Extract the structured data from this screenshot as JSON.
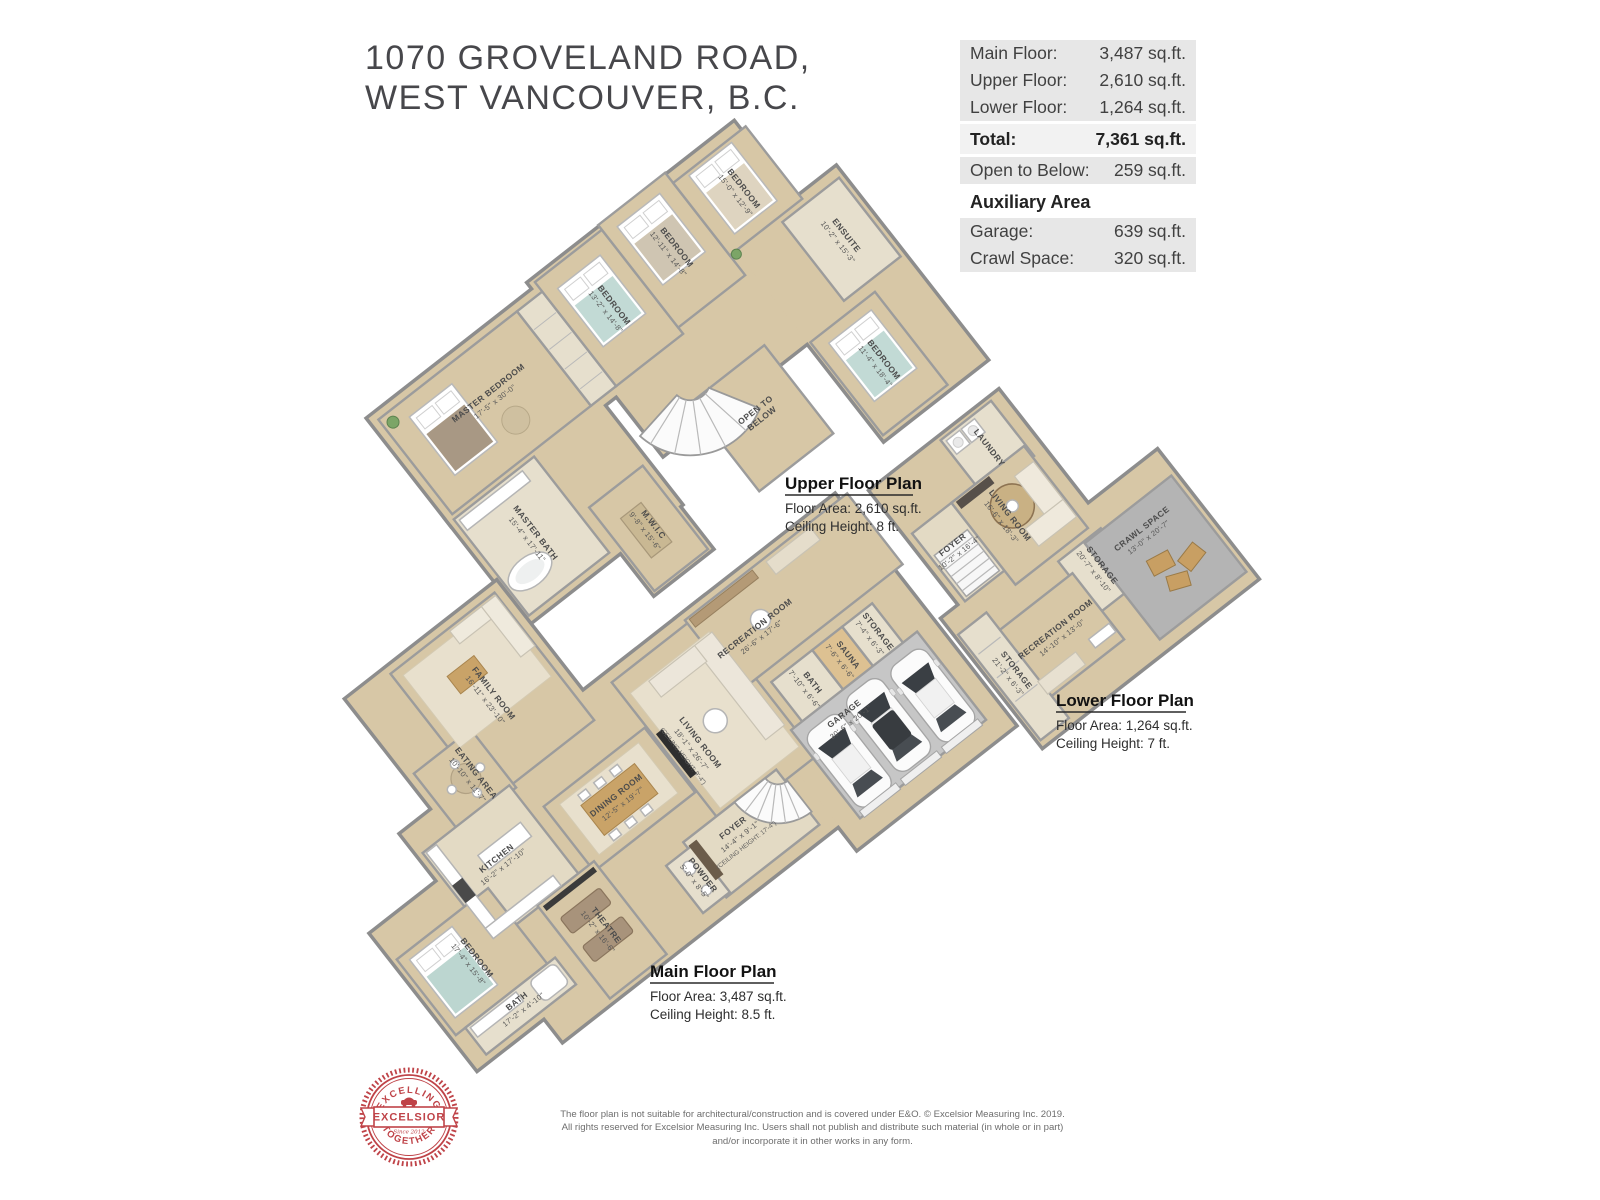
{
  "header": {
    "line1": "1070 GROVELAND ROAD,",
    "line2": "WEST VANCOUVER, B.C."
  },
  "area_table": {
    "rows": [
      {
        "label": "Main Floor:",
        "value": "3,487 sq.ft."
      },
      {
        "label": "Upper Floor:",
        "value": "2,610 sq.ft."
      },
      {
        "label": "Lower Floor:",
        "value": "1,264 sq.ft."
      }
    ],
    "total": {
      "label": "Total:",
      "value": "7,361 sq.ft."
    },
    "open_below": {
      "label": "Open to Below:",
      "value": "259 sq.ft."
    },
    "aux_heading": "Auxiliary Area",
    "aux_rows": [
      {
        "label": "Garage:",
        "value": "639 sq.ft."
      },
      {
        "label": "Crawl Space:",
        "value": "320 sq.ft."
      }
    ]
  },
  "plans": {
    "upper": {
      "title": "Upper Floor Plan",
      "area_line": "Floor Area: 2,610 sq.ft.",
      "ceiling_line": "Ceiling Height: 8 ft.",
      "rooms": [
        {
          "name": "MASTER BEDROOM",
          "dims": "17'-5\" x 30'-0\""
        },
        {
          "name": "BEDROOM",
          "dims": "13'-2\" x 14'-8\""
        },
        {
          "name": "BEDROOM",
          "dims": "12'-11\" x 14'-8\""
        },
        {
          "name": "BEDROOM",
          "dims": "15'-0\" x 12'-9\""
        },
        {
          "name": "ENSUITE",
          "dims": "10'-2\" x 15'-3\""
        },
        {
          "name": "BEDROOM",
          "dims": "11'-4\" x 18'-4\""
        },
        {
          "name": "MASTER BATH",
          "dims": "15'-4\" x 17'-11\""
        },
        {
          "name": "M.W.I.C",
          "dims": "9'-8\" x 15'-6\""
        },
        {
          "name": "OPEN TO",
          "dims": "BELOW"
        }
      ]
    },
    "main": {
      "title": "Main Floor Plan",
      "area_line": "Floor Area: 3,487 sq.ft.",
      "ceiling_line": "Ceiling Height: 8.5 ft.",
      "rooms": [
        {
          "name": "FAMILY ROOM",
          "dims": "16'-11\" x 23'-10\""
        },
        {
          "name": "EATING AREA",
          "dims": "10'-10\" x 11'-7\""
        },
        {
          "name": "KITCHEN",
          "dims": "16'-2\" x 17'-10\""
        },
        {
          "name": "DINING ROOM",
          "dims": "12'-5\" x 19'-7\""
        },
        {
          "name": "LIVING ROOM",
          "dims": "18'-1\" x 26'-7\"",
          "extra": "(CEILING HEIGHT: 9'-4\")"
        },
        {
          "name": "FOYER",
          "dims": "14'-4\" x 9'-1\"",
          "extra": "(CEILING HEIGHT: 17'-4\")"
        },
        {
          "name": "POWDER",
          "dims": "5'-0\" x 8'-5\""
        },
        {
          "name": "THEATRE",
          "dims": "10'-2\" x 16'-6\""
        },
        {
          "name": "BEDROOM",
          "dims": "17'-4\" x 15'-8\""
        },
        {
          "name": "BATH",
          "dims": "17'-2\" x 4'-10\""
        },
        {
          "name": "RECREATION ROOM",
          "dims": "26'-6\" x 17'-6\""
        },
        {
          "name": "BATH",
          "dims": "7'-10\" x 6'-6\""
        },
        {
          "name": "SAUNA",
          "dims": "7'-6\" x 6'-6\""
        },
        {
          "name": "STORAGE",
          "dims": "7'-4\" x 6'-3\""
        },
        {
          "name": "GARAGE",
          "dims": "30'-6\" x 20'-1\""
        }
      ]
    },
    "lower": {
      "title": "Lower Floor Plan",
      "area_line": "Floor Area: 1,264 sq.ft.",
      "ceiling_line": "Ceiling Height: 7 ft.",
      "rooms": [
        {
          "name": "LAUNDRY",
          "dims": ""
        },
        {
          "name": "FOYER",
          "dims": "10'-2\" x 16'-4\""
        },
        {
          "name": "LIVING ROOM",
          "dims": "16'-6\" x 18'-3\""
        },
        {
          "name": "STORAGE",
          "dims": "20'-7\" x 8'-10\""
        },
        {
          "name": "CRAWL SPACE",
          "dims": "13'-0\" x 20'-7\""
        },
        {
          "name": "RECREATION ROOM",
          "dims": "14'-10\" x 13'-0\""
        },
        {
          "name": "STORAGE",
          "dims": "21'-2\" x 6'-3\""
        }
      ]
    }
  },
  "footer": {
    "logo": {
      "arc_top": "EXCELLING",
      "banner": "EXCELSIOR",
      "arc_bottom": "TOGETHER",
      "since": "Since 2012"
    },
    "disclaimer": "The floor plan is not suitable for architectural/construction and is covered under E&O. © Excelsior Measuring Inc. 2019. All rights reserved for Excelsior Measuring Inc. Users shall not publish and distribute such material (in whole or in part) and/or incorporate it in other works in any form."
  },
  "colors": {
    "logo_red": "#bf4348",
    "floor_tan": "#d7c7a6",
    "wall_gray": "#8d8d8d",
    "garage_floor": "#c6c6c6",
    "crawl_floor": "#b4b4b4",
    "table_row_bg": "#e7e7e7",
    "total_row_bg": "#f2f2f2"
  }
}
